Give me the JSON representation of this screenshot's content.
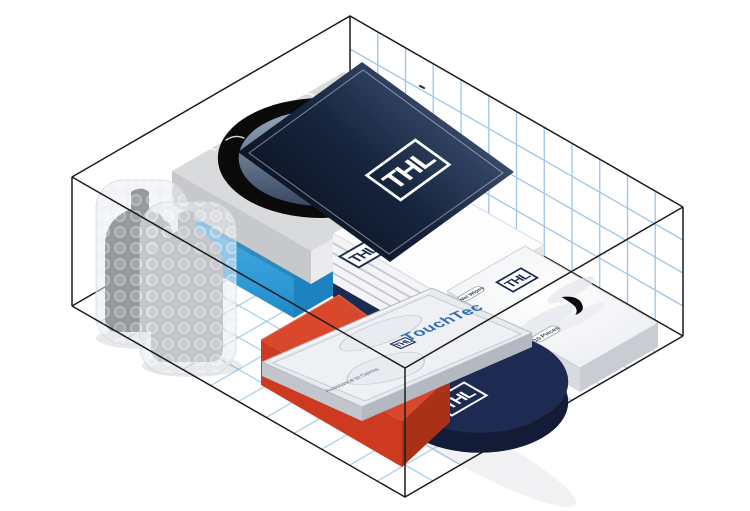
{
  "illustration": {
    "brand": {
      "logo_text": "THL"
    },
    "container": {
      "outline_color": "#1b1c1e",
      "wall_grid_color": "#9fc5e8",
      "floor_grid_color": "#aecfea",
      "background": "#ffffff"
    },
    "panel": {
      "logo_text": "THL",
      "gradient_dark": "#0a111f",
      "gradient_light": "#46597e"
    },
    "stack": {
      "logo_text": "THL"
    },
    "wipes_pack": {
      "type_label": "Wet Wipes",
      "logo_text": "THL",
      "count_label": "10 Pieces"
    },
    "disc": {
      "logo_text": "THL",
      "color": "#1d2a52"
    },
    "blister": {
      "brand_text": "TouchTec",
      "logo_text": "THL",
      "tagline": "Assistance to Germs",
      "brand_text_color": "#2f6db5"
    },
    "colors": {
      "navy": "#1c2b50",
      "blue_box": "#2e9ad6",
      "light_blue_top": "#aad2ee",
      "red_box": "#d9482c",
      "tray_gray": "#d9dadc"
    },
    "items": [
      "bubble-wrapped-bottles",
      "blue-box",
      "gray-tray",
      "navy-brochure-panel",
      "white-box-stack",
      "wet-wipes-pack",
      "navy-disc",
      "red-box",
      "blister-pack"
    ]
  }
}
